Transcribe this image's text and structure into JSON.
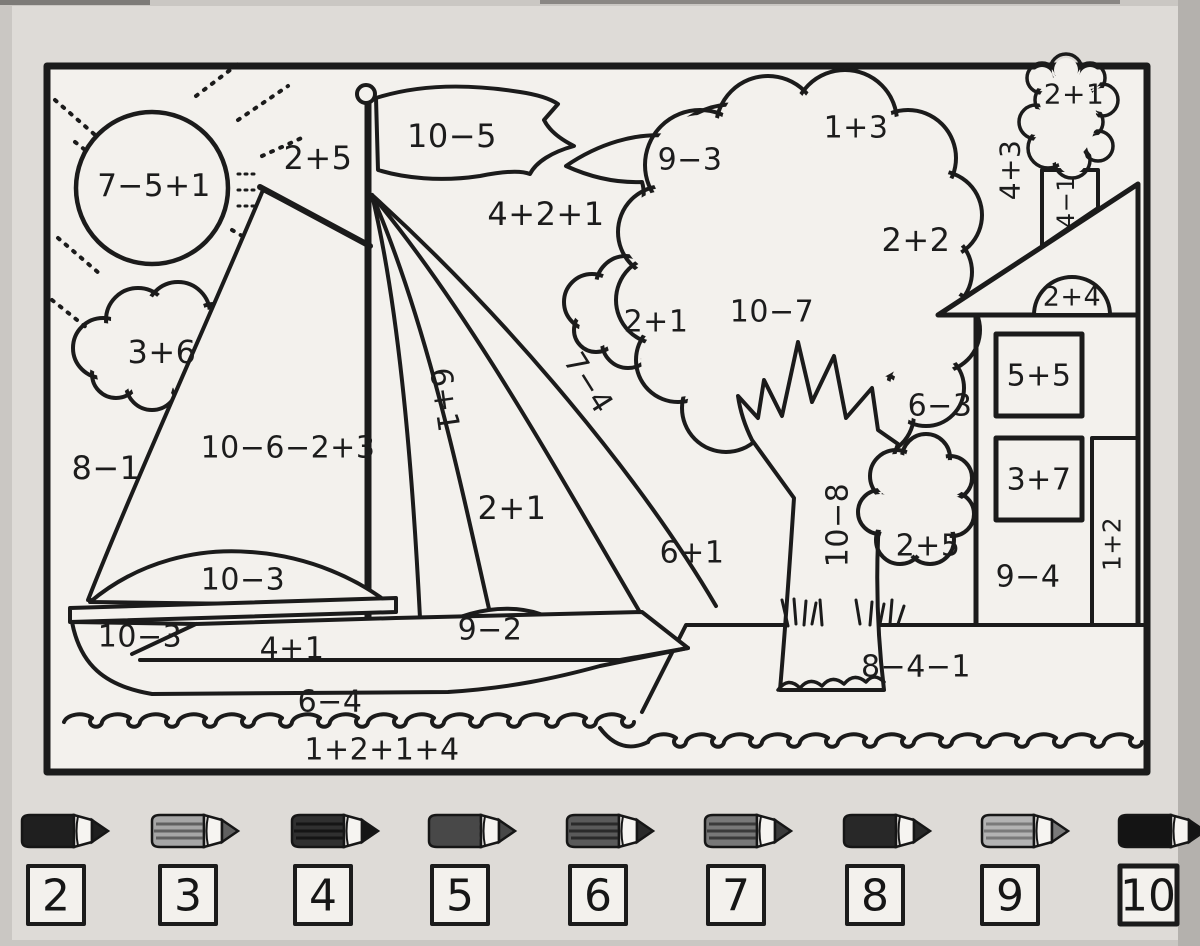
{
  "worksheet": {
    "kind": "color-by-number math worksheet",
    "labels": {
      "sun": "7−5+1",
      "sky_upper_left": "2+5",
      "flag": "10−5",
      "sky_mid": "4+2+1",
      "bird": "9−3",
      "foliage_top": "1+3",
      "smoke": "2+1",
      "sky_right_vertical": "4+3",
      "chimney_vertical": "4−1",
      "foliage_mid": "2+2",
      "attic_window": "2+4",
      "cloud_left": "3+6",
      "sky_left": "8−1",
      "mainsail": "10−6−2+3",
      "sail_inner_vertical": "6+1",
      "sail_middle": "2+1",
      "sail_outer_vertical": "7−4",
      "cloud_mid": "2+1",
      "foliage_left": "10−7",
      "foliage_right": "6−3",
      "window_upper": "5+5",
      "window_lower": "3+7",
      "trunk_vertical": "10−8",
      "sky_low": "6+1",
      "bush": "2+5",
      "house_wall": "9−4",
      "door_vertical": "1+2",
      "boom_sail": "10−3",
      "hull_left": "10−3",
      "hull_mid": "4+1",
      "stern_sail": "9−2",
      "hull_low": "6−4",
      "water": "1+2+1+4",
      "bank": "8−4−1"
    },
    "legend": {
      "pencils": [
        {
          "number": "2",
          "body": "#1f1f1f",
          "stripe": "#1f1f1f"
        },
        {
          "number": "3",
          "body": "#a6a6a6",
          "stripe": "#606060"
        },
        {
          "number": "4",
          "body": "#303030",
          "stripe": "#151515"
        },
        {
          "number": "5",
          "body": "#484848",
          "stripe": "#484848"
        },
        {
          "number": "6",
          "body": "#5a5a5a",
          "stripe": "#2a2a2a"
        },
        {
          "number": "7",
          "body": "#787878",
          "stripe": "#3a3a3a"
        },
        {
          "number": "8",
          "body": "#282828",
          "stripe": "#282828"
        },
        {
          "number": "9",
          "body": "#b3b3b3",
          "stripe": "#7a7a7a"
        },
        {
          "number": "10",
          "body": "#141414",
          "stripe": "#141414"
        }
      ]
    }
  }
}
